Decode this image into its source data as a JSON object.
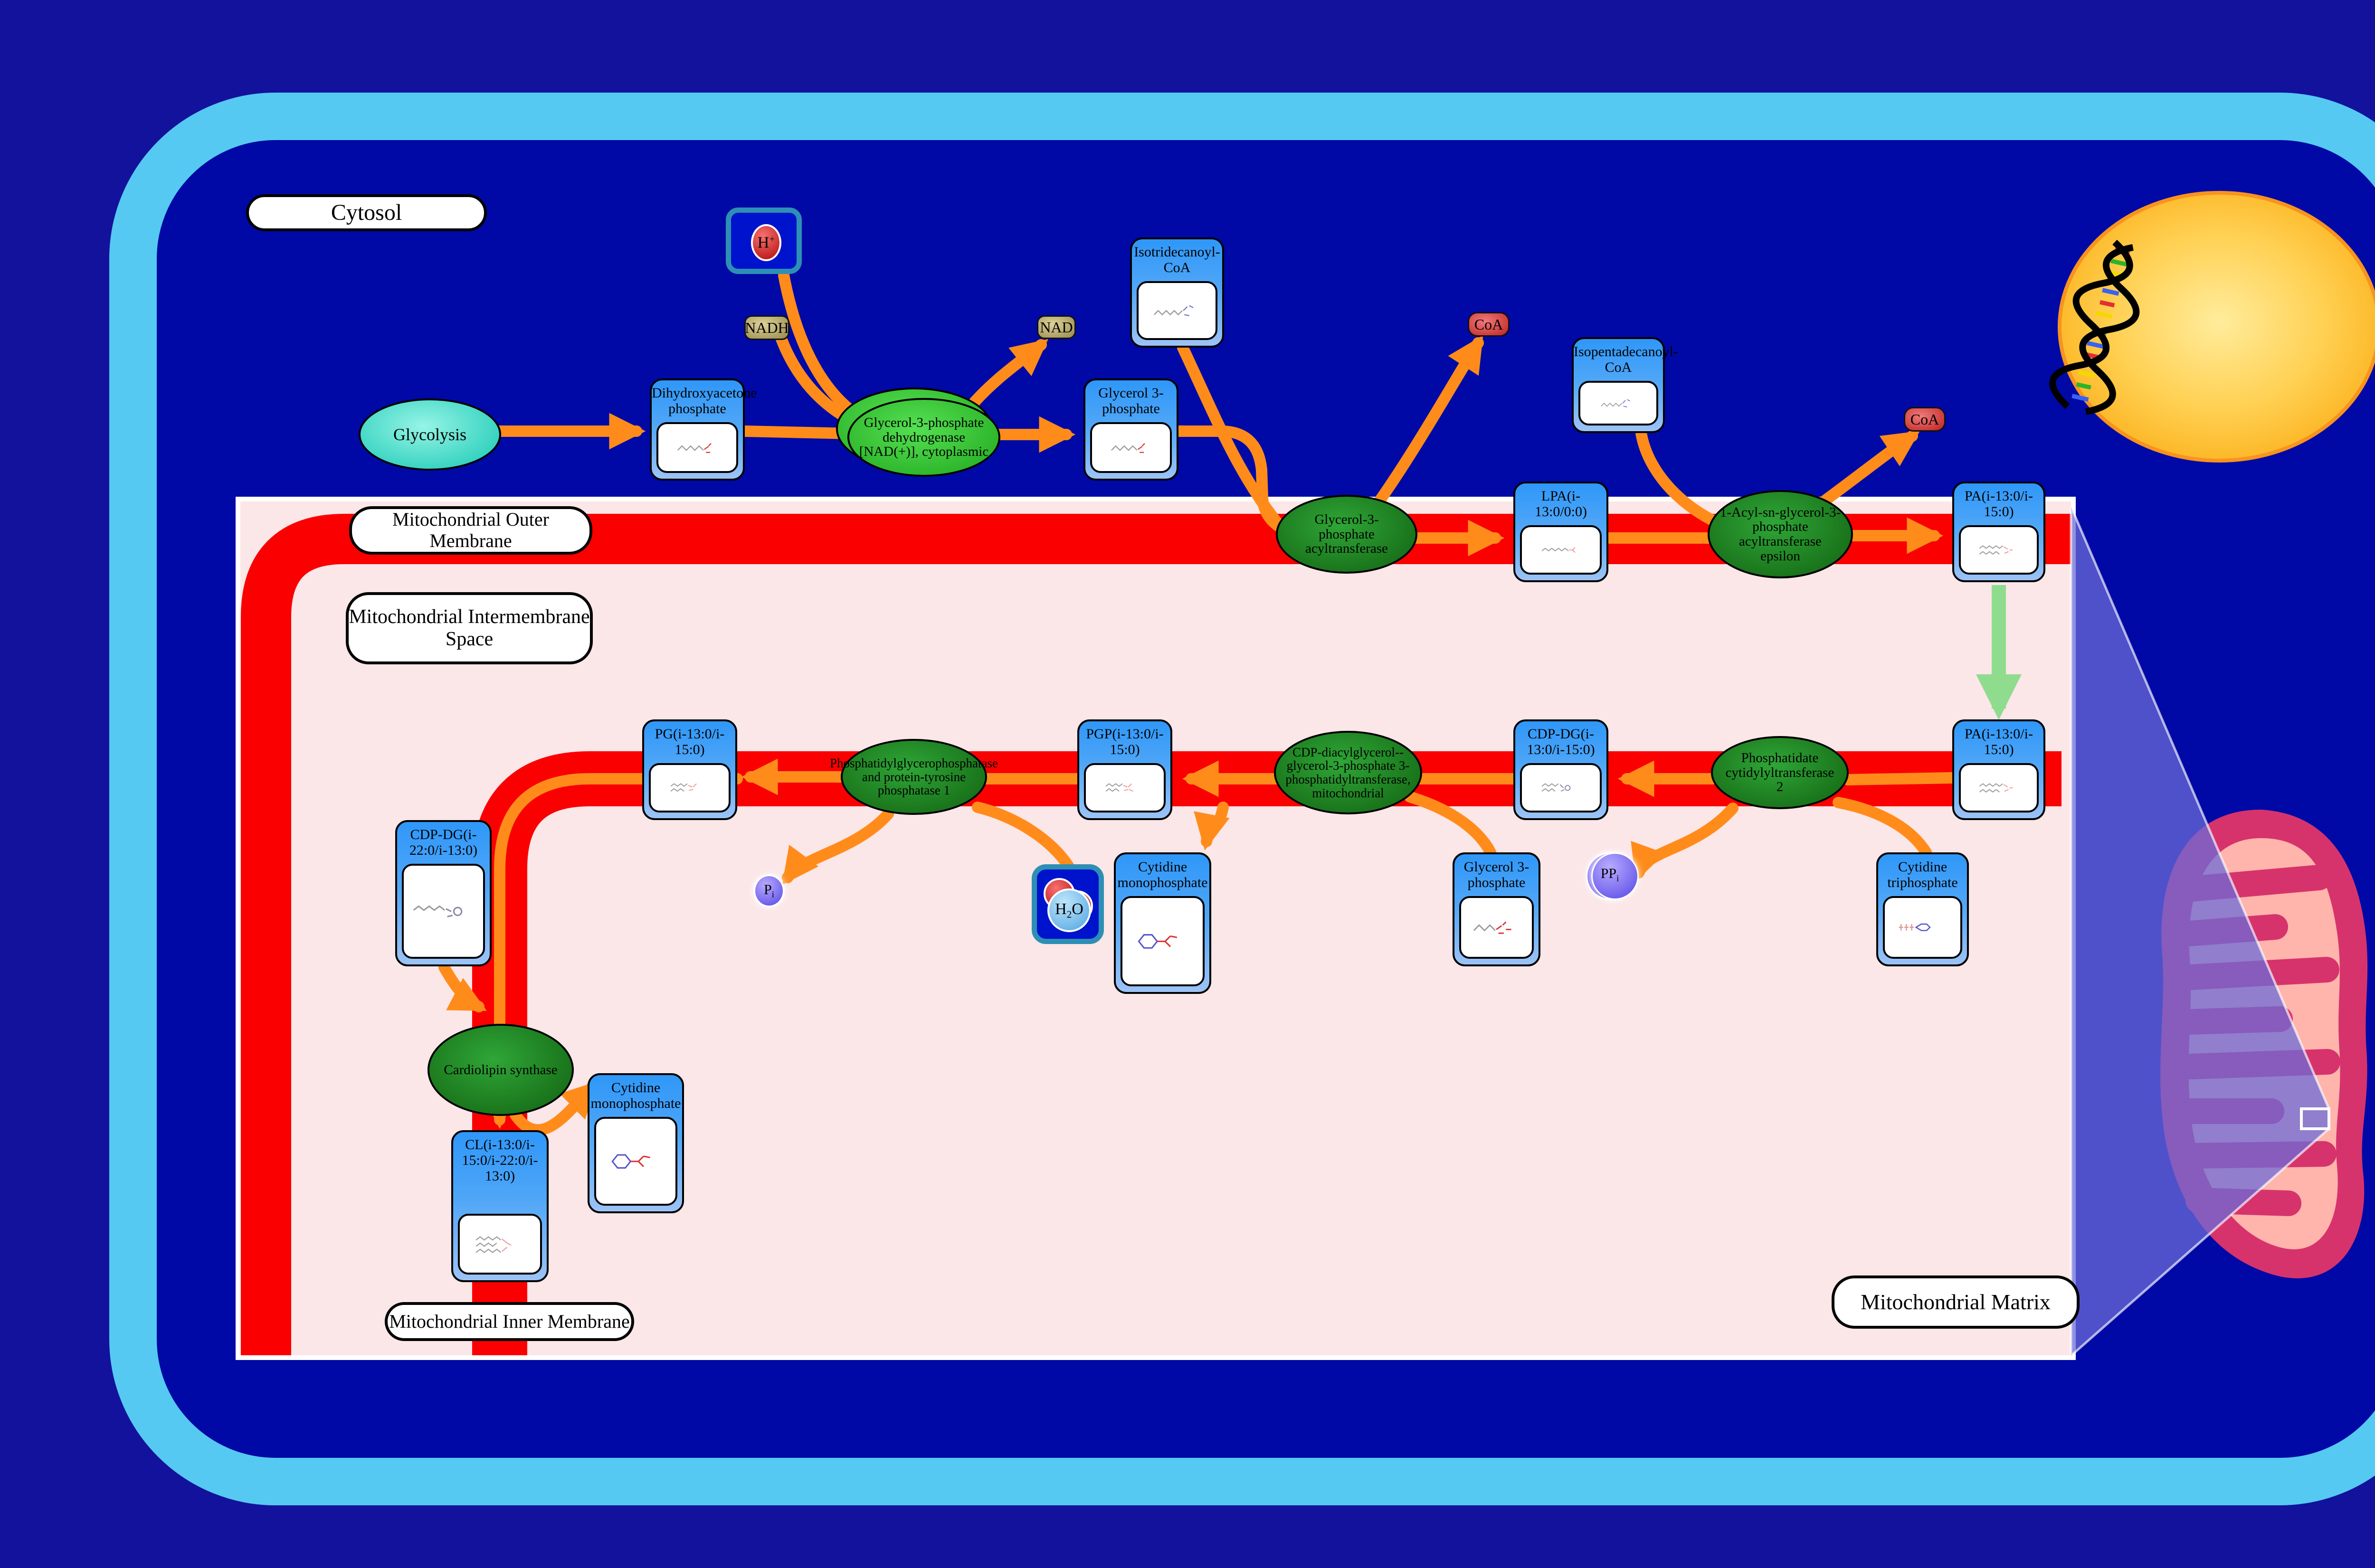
{
  "compartments": {
    "cytosol": "Cytosol",
    "outer_membrane": "Mitochondrial Outer Membrane",
    "intermembrane_space": "Mitochondrial Intermembrane Space",
    "inner_membrane": "Mitochondrial Inner Membrane",
    "matrix": "Mitochondrial Matrix"
  },
  "process": {
    "glycolysis": "Glycolysis"
  },
  "metabolites": {
    "dhap": {
      "title": "Dihydroxyacetone phosphate"
    },
    "g3p_top": {
      "title": "Glycerol 3-phosphate"
    },
    "isotridecanoyl_coa": {
      "title": "Isotridecanoyl-CoA"
    },
    "isopentadecanoyl_coa": {
      "title": "Isopentadecanoyl-CoA"
    },
    "lpa": {
      "title": "LPA(i-13:0/0:0)"
    },
    "pa_outer": {
      "title": "PA(i-13:0/i-15:0)"
    },
    "pa_inner": {
      "title": "PA(i-13:0/i-15:0)"
    },
    "cdp_dg_13_15": {
      "title": "CDP-DG(i-13:0/i-15:0)"
    },
    "pgp": {
      "title": "PGP(i-13:0/i-15:0)"
    },
    "pg": {
      "title": "PG(i-13:0/i-15:0)"
    },
    "cmp_mid": {
      "title": "Cytidine monophosphate"
    },
    "g3p_bottom": {
      "title": "Glycerol 3-phosphate"
    },
    "ctp": {
      "title": "Cytidine triphosphate"
    },
    "cdp_dg_22_13": {
      "title": "CDP-DG(i-22:0/i-13:0)"
    },
    "cl": {
      "title": "CL(i-13:0/i-15:0/i-22:0/i-13:0)"
    },
    "cmp_bottom": {
      "title": "Cytidine monophosphate"
    }
  },
  "enzymes": {
    "gpd_cytoplasmic": {
      "name": "Glycerol-3-phosphate dehydrogenase [NAD(+)], cytoplasmic"
    },
    "gpat": {
      "name": "Glycerol-3-phosphate acyltransferase"
    },
    "agpat_epsilon": {
      "name": "1-Acyl-sn-glycerol-3-phosphate acyltransferase epsilon"
    },
    "ptpmt1": {
      "name": "Phosphatidylglycerophosphatase and protein-tyrosine phosphatase 1"
    },
    "pgs1": {
      "name": "CDP-diacylglycerol--glycerol-3-phosphate 3-phosphatidyltransferase, mitochondrial"
    },
    "cds2": {
      "name": "Phosphatidate cytidylyltransferase 2"
    },
    "cardiolipin_synthase": {
      "name": "Cardiolipin synthase"
    }
  },
  "small_molecules": {
    "h_plus": {
      "base": "H",
      "sup": "+"
    },
    "nadh": "NADH",
    "nad": "NAD",
    "coa": "CoA",
    "pi": {
      "base": "P",
      "sub": "i"
    },
    "ppi": {
      "base": "PP",
      "sub": "i"
    },
    "h2o": {
      "base": "H",
      "sub": "2",
      "tail": "O"
    }
  },
  "colors": {
    "cell_border": "#55C9F2",
    "cytosol_bg": "#0009A6",
    "pathway_bg": "#FBE6E8",
    "membrane": "#FA0000",
    "arrow": "#FF8C1A",
    "transport_arrow": "#8FDC8F",
    "node_header": "#2F97F8",
    "enzyme_dark": "#176E17",
    "enzyme_bright": "#27AE24",
    "nucleus": "#FFC93C",
    "mitochondrion": "#D6336C",
    "zoom_callout": "#6A6AD8"
  }
}
